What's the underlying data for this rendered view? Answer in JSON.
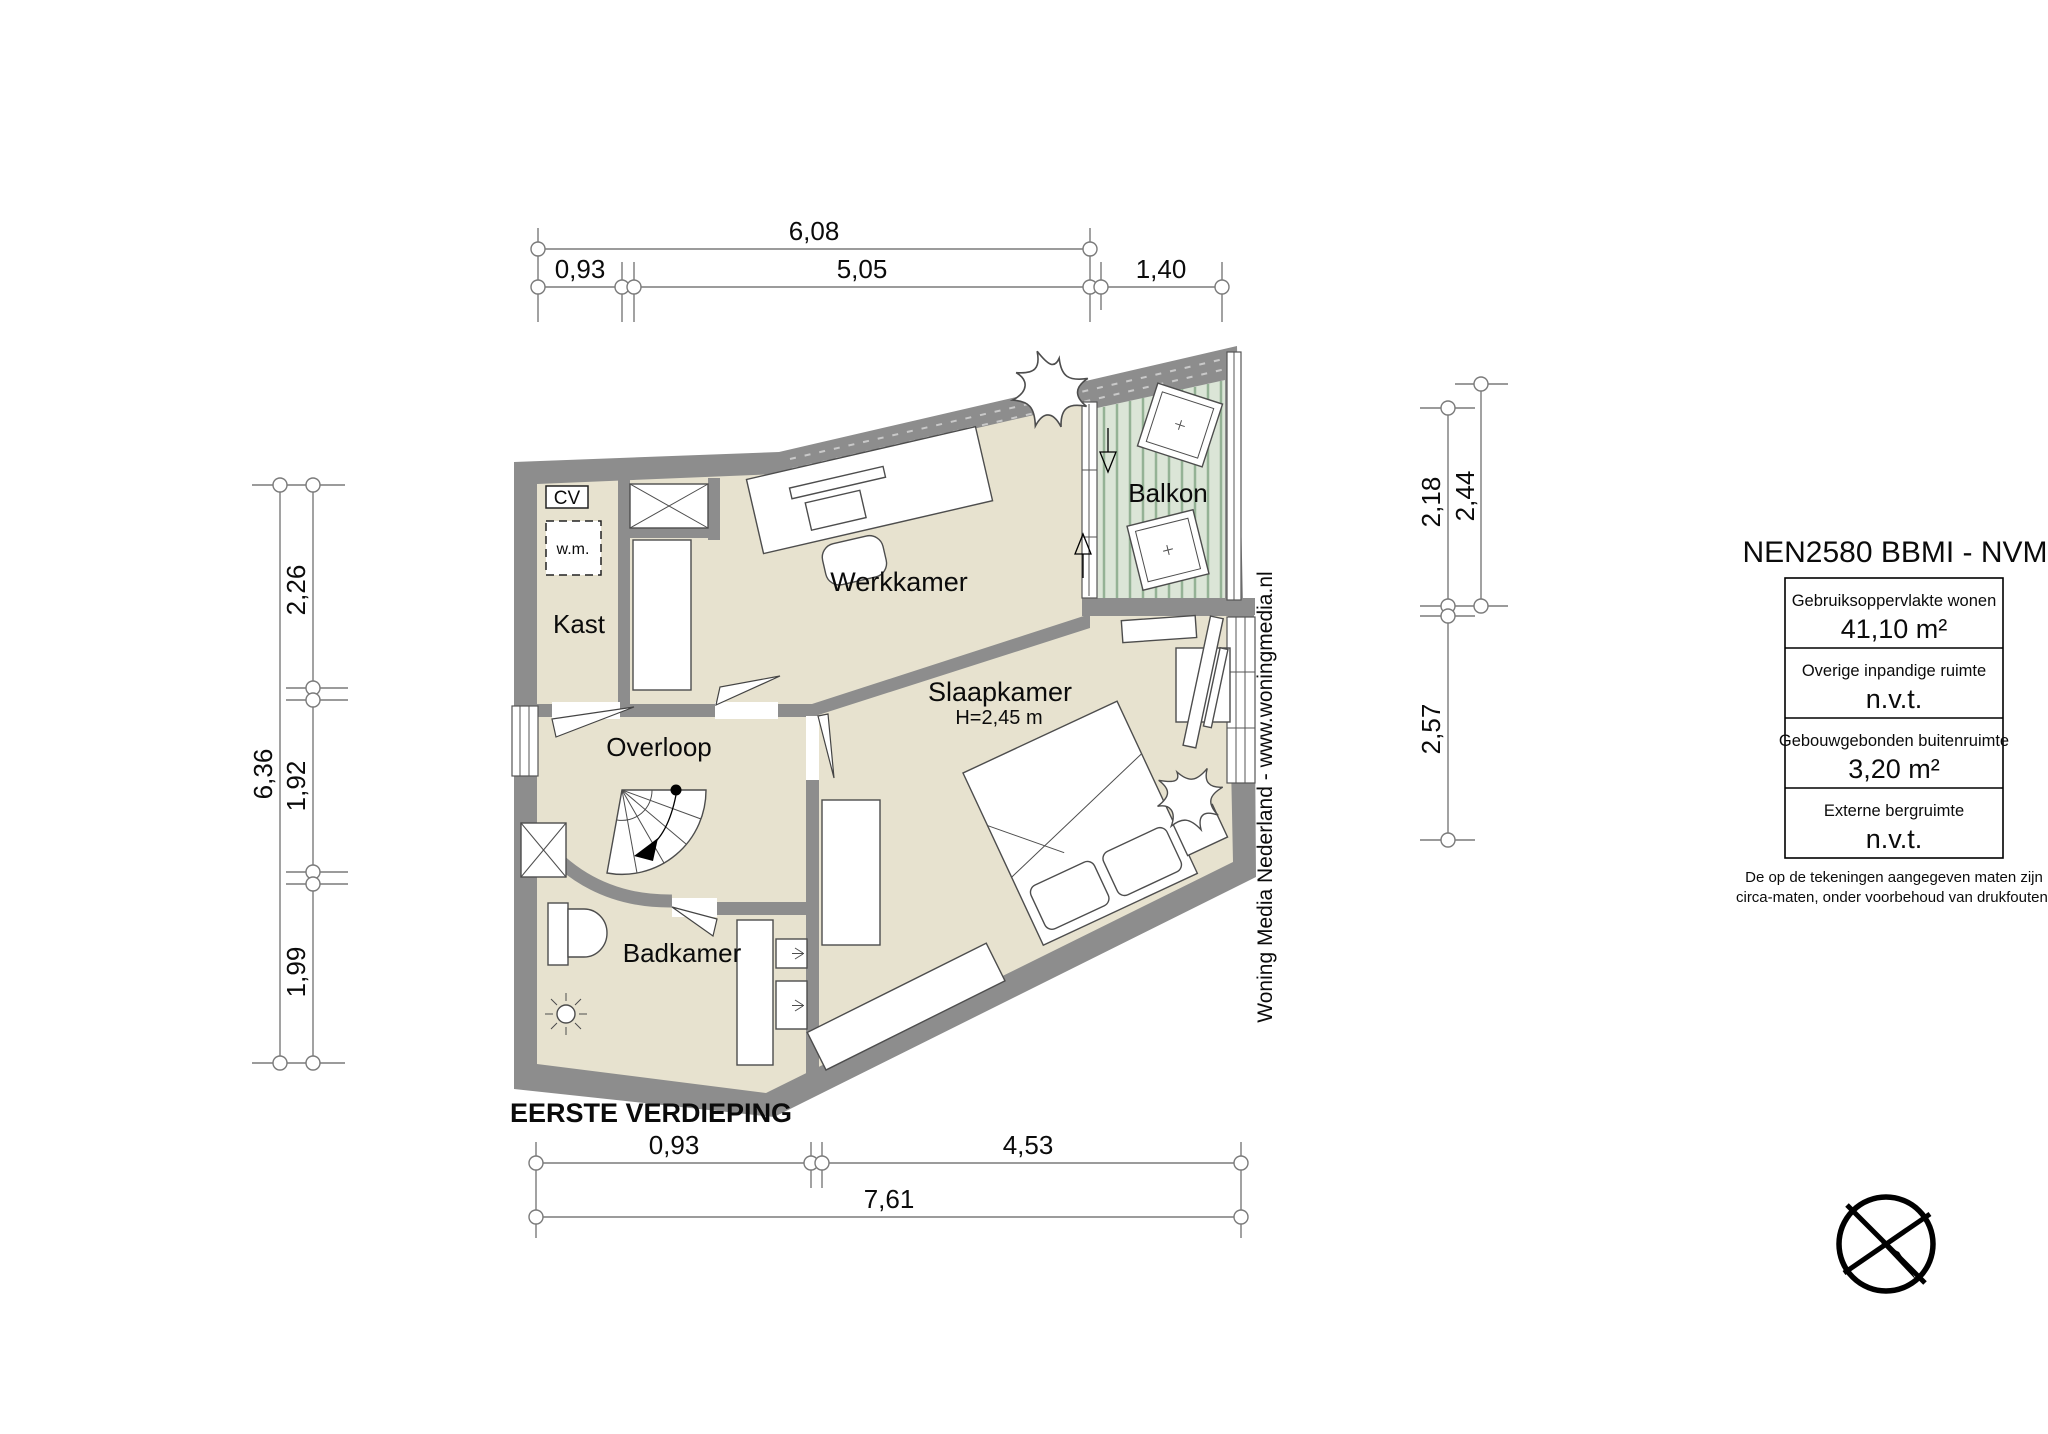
{
  "floor_plan": {
    "title": "EERSTE VERDIEPING",
    "rooms": {
      "werkkamer": "Werkkamer",
      "slaapkamer": "Slaapkamer",
      "slaapkamer_height": "H=2,45 m",
      "overloop": "Overloop",
      "badkamer": "Badkamer",
      "balkon": "Balkon",
      "kast": "Kast",
      "cv": "CV",
      "wm": "w.m."
    },
    "dimensions": {
      "top": {
        "total": "6,08",
        "segments": [
          "0,93",
          "5,05",
          "1,40"
        ]
      },
      "left": {
        "total": "6,36",
        "segments": [
          "2,26",
          "1,92",
          "1,99"
        ]
      },
      "right": {
        "upper": [
          "2,18",
          "2,44"
        ],
        "lower": "2,57"
      },
      "bottom": {
        "segments": [
          "0,93",
          "4,53"
        ],
        "total": "7,61"
      }
    }
  },
  "legend": {
    "title": "NEN2580 BBMI - NVM",
    "rows": [
      {
        "label": "Gebruiksoppervlakte wonen",
        "value": "41,10 m²"
      },
      {
        "label": "Overige inpandige ruimte",
        "value": "n.v.t."
      },
      {
        "label": "Gebouwgebonden buitenruimte",
        "value": "3,20 m²"
      },
      {
        "label": "Externe bergruimte",
        "value": "n.v.t."
      }
    ],
    "disclaimer_line1": "De op de tekeningen aangegeven maten zijn",
    "disclaimer_line2": "circa-maten, onder voorbehoud van drukfouten."
  },
  "branding": {
    "watermark": "Woning Media Nederland - www.woningmedia.nl"
  },
  "colors": {
    "wall": "#8d8d8d",
    "floor": "#e7e2cf",
    "balcony_floor": "#dbe5d7",
    "balcony_stripe": "#94b295",
    "dimension_line": "#7a7a7a"
  }
}
